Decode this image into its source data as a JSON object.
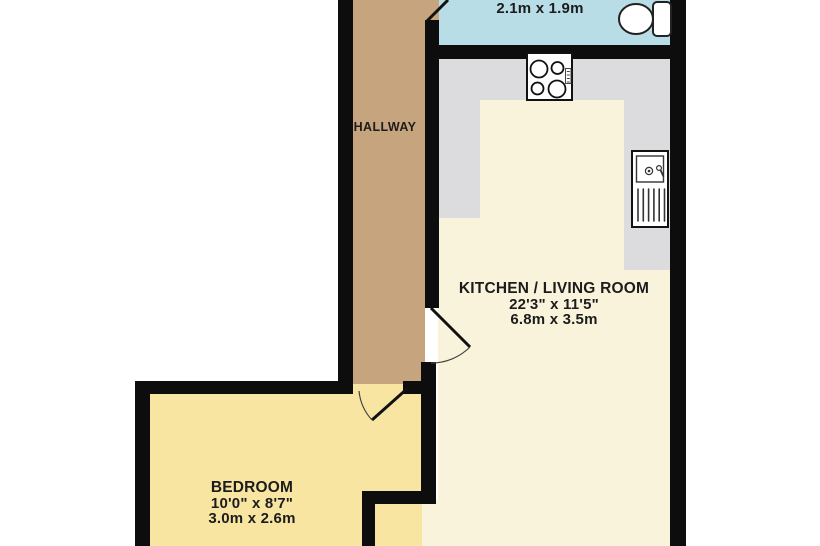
{
  "rooms": {
    "bathroom": {
      "dims_metric": "2.1m x 1.9m"
    },
    "hallway": {
      "name": "HALLWAY"
    },
    "kitchen_living": {
      "name": "KITCHEN / LIVING ROOM",
      "dims_imperial": "22'3\" x 11'5\"",
      "dims_metric": "6.8m x 3.5m"
    },
    "bedroom": {
      "name": "BEDROOM",
      "dims_imperial": "10'0\" x 8'7\"",
      "dims_metric": "3.0m x 2.6m"
    }
  },
  "colors": {
    "background": "#ffffff",
    "wall": "#0d0d0d",
    "bathroom_floor": "#b9dde6",
    "hallway_floor": "#c6a57e",
    "kitchen_floor": "#faf3dc",
    "counter": "#dcdcde",
    "bedroom_floor": "#f8e5a2",
    "text": "#1c1c1c"
  },
  "fixtures": {
    "toilet": "toilet-icon",
    "hob": "hob-4-burner-icon",
    "sink": "sink-drainer-icon"
  }
}
